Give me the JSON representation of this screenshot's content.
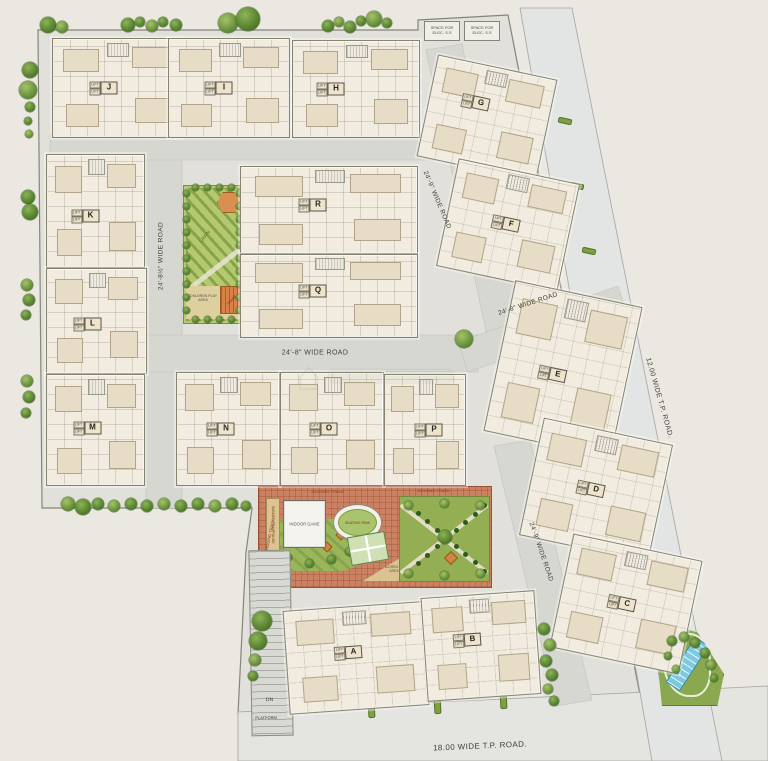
{
  "plan_title": "Residential township site plan",
  "palette": {
    "background": "#ebe8e1",
    "estate_fill": "#e1e0da",
    "road_fill": "#d7d7d2",
    "tp_road_fill": "#e3e5e5",
    "building_fill": "#f1ecdf",
    "park_green": "#b4c96e",
    "garden_green": "#93ae53",
    "paving_brick": "#cb8263",
    "pool_blue": "#7cc9e0",
    "gazebo_orange": "#d98f4f",
    "tree_green": "#5b8432"
  },
  "elec_boxes": [
    {
      "label": "SPACE FOR ELEC. S.S"
    },
    {
      "label": "SPACE FOR ELEC. S.S"
    }
  ],
  "core_label": "LIFT",
  "buildings": [
    {
      "letter": "J",
      "x": 52,
      "y": 38,
      "w": 128,
      "h": 98,
      "rot": 0,
      "dx": -8,
      "dy": 0
    },
    {
      "letter": "I",
      "x": 168,
      "y": 38,
      "w": 120,
      "h": 98,
      "rot": 0,
      "dx": -5,
      "dy": 0
    },
    {
      "letter": "H",
      "x": 292,
      "y": 40,
      "w": 126,
      "h": 96,
      "rot": 0,
      "dx": -20,
      "dy": 0
    },
    {
      "letter": "K",
      "x": 46,
      "y": 154,
      "w": 97,
      "h": 112,
      "rot": 0,
      "dx": -5,
      "dy": 5
    },
    {
      "letter": "L",
      "x": 46,
      "y": 268,
      "w": 99,
      "h": 104,
      "rot": 0,
      "dx": -4,
      "dy": 3
    },
    {
      "letter": "M",
      "x": 46,
      "y": 374,
      "w": 97,
      "h": 110,
      "rot": 0,
      "dx": -3,
      "dy": -2
    },
    {
      "letter": "R",
      "x": 240,
      "y": 166,
      "w": 176,
      "h": 86,
      "rot": 0,
      "dx": -11,
      "dy": -5
    },
    {
      "letter": "Q",
      "x": 240,
      "y": 254,
      "w": 176,
      "h": 82,
      "rot": 0,
      "dx": -11,
      "dy": -5
    },
    {
      "letter": "N",
      "x": 176,
      "y": 372,
      "w": 102,
      "h": 112,
      "rot": 0,
      "dx": -2,
      "dy": 0
    },
    {
      "letter": "O",
      "x": 280,
      "y": 372,
      "w": 102,
      "h": 112,
      "rot": 0,
      "dx": -3,
      "dy": 0
    },
    {
      "letter": "P",
      "x": 384,
      "y": 374,
      "w": 80,
      "h": 110,
      "rot": 0,
      "dx": 9,
      "dy": 0
    },
    {
      "letter": "G",
      "x": 426,
      "y": 66,
      "w": 120,
      "h": 102,
      "rot": 12,
      "dx": -9,
      "dy": -13
    },
    {
      "letter": "F",
      "x": 446,
      "y": 170,
      "w": 122,
      "h": 108,
      "rot": 12,
      "dx": 3,
      "dy": -1
    },
    {
      "letter": "E",
      "x": 498,
      "y": 292,
      "w": 128,
      "h": 152,
      "rot": 12,
      "dx": -4,
      "dy": 7
    },
    {
      "letter": "D",
      "x": 530,
      "y": 430,
      "w": 130,
      "h": 118,
      "rot": 12,
      "dx": 0,
      "dy": 0
    },
    {
      "letter": "C",
      "x": 560,
      "y": 546,
      "w": 130,
      "h": 114,
      "rot": 12,
      "dx": 1,
      "dy": 0
    },
    {
      "letter": "A",
      "x": 286,
      "y": 606,
      "w": 138,
      "h": 102,
      "rot": -4,
      "dx": -2,
      "dy": -6
    },
    {
      "letter": "B",
      "x": 424,
      "y": 594,
      "w": 112,
      "h": 102,
      "rot": -4,
      "dx": -8,
      "dy": -7
    }
  ],
  "road_labels": [
    {
      "text": "24'-8½\" WIDE ROAD",
      "x": 161,
      "y": 256,
      "rot": -90,
      "size": 6.5
    },
    {
      "text": "24'-8\" WIDE ROAD",
      "x": 315,
      "y": 353,
      "rot": 0,
      "size": 7
    },
    {
      "text": "24'-9\" WIDE ROAD",
      "x": 437,
      "y": 200,
      "rot": 67,
      "size": 6.5
    },
    {
      "text": "24'-8\" WIDE ROAD",
      "x": 528,
      "y": 304,
      "rot": -18,
      "size": 6.5
    },
    {
      "text": "24'-9\" WIDE ROAD",
      "x": 541,
      "y": 552,
      "rot": 71,
      "size": 6.5
    },
    {
      "text": "12.00 WIDE T.P. ROAD.",
      "x": 659,
      "y": 398,
      "rot": 74,
      "size": 7
    },
    {
      "text": "18.00 WIDE T.P. ROAD.",
      "x": 480,
      "y": 746,
      "rot": -2.5,
      "size": 8
    }
  ],
  "park": {
    "lawn_label": "LAWN",
    "children_label": "CHILDREN PLAY AREA",
    "stage_label": "STAGE"
  },
  "amenity": {
    "jogging_labels": [
      "JOGGING TRACK",
      "JOGGING TRACK",
      "JOGGING TRACK"
    ],
    "indoor_game": "INDOOR GAME",
    "skating_rink": "SKATING RINK",
    "children_play": "CHILDREN PLAY AREA",
    "trampoline": "BUNGEE TRAMPOLINE"
  },
  "ramp": {
    "dn": "DN",
    "platform": "PLATFORM"
  },
  "trees": [
    [
      48,
      25,
      8
    ],
    [
      62,
      27,
      6
    ],
    [
      128,
      25,
      7
    ],
    [
      140,
      22,
      5
    ],
    [
      152,
      26,
      6
    ],
    [
      163,
      22,
      5
    ],
    [
      176,
      25,
      6
    ],
    [
      228,
      23,
      10
    ],
    [
      248,
      19,
      12
    ],
    [
      328,
      26,
      6
    ],
    [
      339,
      22,
      5
    ],
    [
      350,
      27,
      6
    ],
    [
      361,
      21,
      5
    ],
    [
      374,
      19,
      8
    ],
    [
      387,
      23,
      5
    ],
    [
      30,
      70,
      8
    ],
    [
      28,
      90,
      9
    ],
    [
      30,
      107,
      5
    ],
    [
      28,
      121,
      4
    ],
    [
      29,
      134,
      4
    ],
    [
      28,
      197,
      7
    ],
    [
      30,
      212,
      8
    ],
    [
      27,
      285,
      6
    ],
    [
      29,
      300,
      6
    ],
    [
      26,
      315,
      5
    ],
    [
      27,
      381,
      6
    ],
    [
      29,
      397,
      6
    ],
    [
      26,
      413,
      5
    ],
    [
      68,
      504,
      7
    ],
    [
      83,
      507,
      8
    ],
    [
      98,
      504,
      6
    ],
    [
      114,
      506,
      6
    ],
    [
      131,
      504,
      6
    ],
    [
      147,
      506,
      6
    ],
    [
      164,
      504,
      6
    ],
    [
      181,
      506,
      6
    ],
    [
      198,
      504,
      6
    ],
    [
      215,
      506,
      6
    ],
    [
      232,
      504,
      6
    ],
    [
      246,
      506,
      5
    ],
    [
      464,
      339,
      9
    ],
    [
      262,
      621,
      10
    ],
    [
      258,
      641,
      9
    ],
    [
      255,
      660,
      6
    ],
    [
      253,
      676,
      5
    ],
    [
      544,
      629,
      6
    ],
    [
      550,
      645,
      6
    ],
    [
      546,
      661,
      6
    ],
    [
      552,
      675,
      6
    ],
    [
      548,
      689,
      5
    ],
    [
      554,
      701,
      5
    ],
    [
      672,
      641,
      5
    ],
    [
      684,
      637,
      5
    ],
    [
      695,
      643,
      5
    ],
    [
      705,
      653,
      5
    ],
    [
      711,
      665,
      5
    ],
    [
      714,
      678,
      4
    ],
    [
      668,
      656,
      4
    ],
    [
      676,
      669,
      4
    ]
  ],
  "verges": [
    [
      558,
      118,
      12,
      4,
      12
    ],
    [
      570,
      183,
      12,
      4,
      12
    ],
    [
      582,
      248,
      12,
      4,
      12
    ],
    [
      594,
      313,
      12,
      4,
      12
    ],
    [
      606,
      378,
      12,
      4,
      12
    ],
    [
      618,
      443,
      12,
      4,
      12
    ],
    [
      630,
      508,
      12,
      4,
      12
    ],
    [
      641,
      572,
      12,
      4,
      12
    ],
    [
      650,
      630,
      12,
      4,
      12
    ],
    [
      368,
      700,
      5,
      16,
      -3
    ],
    [
      434,
      696,
      5,
      16,
      -3
    ],
    [
      500,
      691,
      5,
      16,
      -3
    ],
    [
      530,
      92,
      10,
      4,
      12
    ]
  ]
}
